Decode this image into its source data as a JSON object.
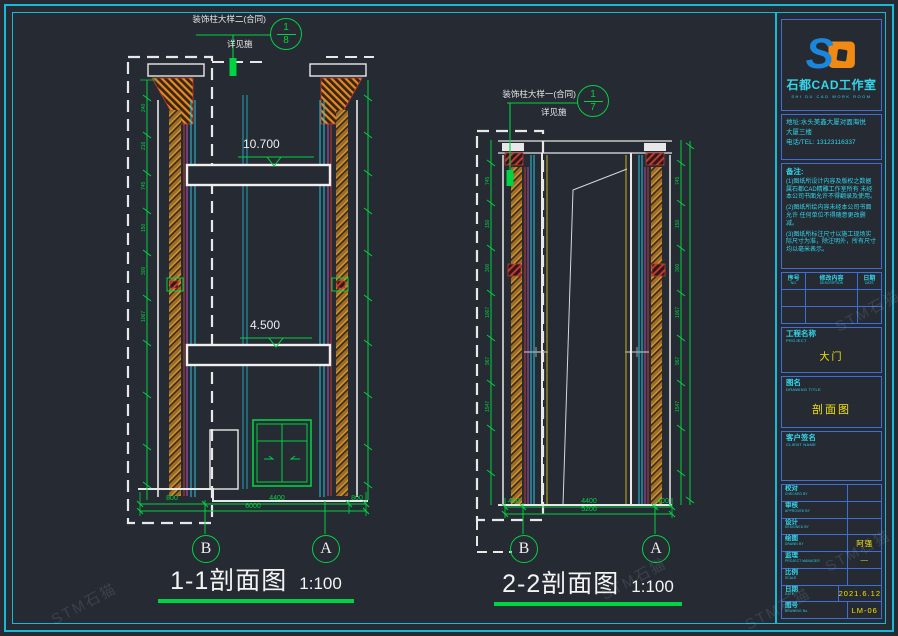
{
  "views": [
    {
      "name": "1-1",
      "title": "1-1剖面图",
      "scale": "1:100",
      "grid_left": "B",
      "grid_right": "A",
      "levels": {
        "upper": "10.700",
        "lower": "4.500"
      },
      "dims": {
        "left": "800",
        "middle": "4400",
        "right": "800",
        "total": "6000"
      },
      "callout": {
        "label": "装饰柱大样二(合同)",
        "sub": "详见施",
        "num": "1",
        "den": "8"
      }
    },
    {
      "name": "2-2",
      "title": "2-2剖面图",
      "scale": "1:100",
      "grid_left": "B",
      "grid_right": "A",
      "dims": {
        "left": "400",
        "middle": "4400",
        "right": "400",
        "total": "5200"
      },
      "callout": {
        "label": "装饰柱大样一(合同)",
        "sub": "详见施",
        "num": "1",
        "den": "7"
      }
    }
  ],
  "side_dims": [
    "240",
    "216",
    "745",
    "150",
    "300",
    "1067",
    "967",
    "1547"
  ],
  "titleblock": {
    "studio": "石都CAD工作室",
    "studio_sub": "SHI DU CAD WORK ROOM",
    "address_line1": "地址:水头美鑫大厦对面海悦",
    "address_line2": "大厦三楼",
    "phone": "电话/TEL: 13123116337",
    "notes_title": "备注:",
    "notes": [
      "(1)图纸所设计内容及版权之数据属石都CAD精雕工作室所有 未经本公司书面允许不得翻录及使用。",
      "(2)图纸所绘内容未经本公司书面允许 任何单位不得随意更改删减。",
      "(3)图纸所标注尺寸以施工现场实际尺寸为准，除注明外，所有尺寸均以毫米表示。"
    ],
    "rev_headers": [
      {
        "zh": "序号",
        "en": "NO."
      },
      {
        "zh": "修改内容",
        "en": "DESCRIPTION"
      },
      {
        "zh": "日期",
        "en": "DATE"
      }
    ],
    "project": {
      "zh": "工程名称",
      "en": "PROJECT",
      "value": "大门"
    },
    "drawing": {
      "zh": "图名",
      "en": "DRAWING TITLE",
      "value": "剖面图"
    },
    "client": {
      "zh": "客户签名",
      "en": "CLIENT NAME"
    },
    "sign_rows": [
      {
        "zh": "校对",
        "en": "CHECKED BY",
        "value": ""
      },
      {
        "zh": "审核",
        "en": "APPROVED BY",
        "value": ""
      },
      {
        "zh": "设计",
        "en": "DESIGNED BY",
        "value": ""
      },
      {
        "zh": "绘图",
        "en": "DRAWN BY",
        "value": "阿强"
      },
      {
        "zh": "监理",
        "en": "PROJECT MANAGER",
        "value": "—"
      },
      {
        "zh": "比例",
        "en": "SCALE",
        "value": ""
      },
      {
        "zh": "日期",
        "en": "DATE",
        "value": "2021.6.12"
      },
      {
        "zh": "图号",
        "en": "DRAWING No.",
        "value": "LM-06"
      }
    ]
  },
  "watermark": {
    "text": "STM石猫"
  }
}
